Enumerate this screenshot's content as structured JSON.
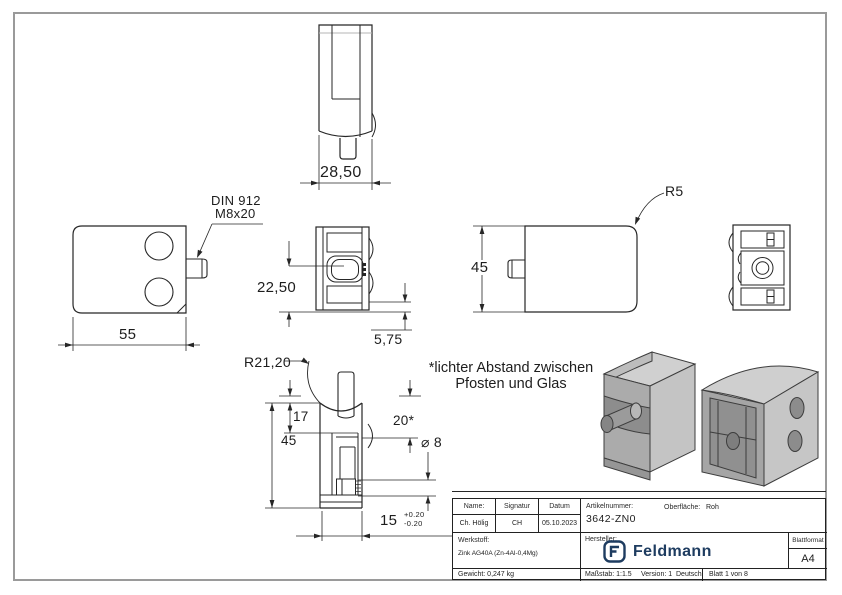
{
  "meta": {
    "line_color": "#262626",
    "frame_color": "#9a9a9a",
    "brand_color": "#1e3c60"
  },
  "views": {
    "top_view": {
      "dim_width": "28,50"
    },
    "front_left_view": {
      "screw_note_line1": "DIN 912",
      "screw_note_line2": "M8x20",
      "dim_width": "55"
    },
    "front_view": {
      "dim_center_height": "22,50",
      "dim_offset": "5,75"
    },
    "side_view": {
      "dim_radius": "R5",
      "dim_height": "45"
    },
    "back_view": {},
    "section_view": {
      "dim_radius": "R21,20",
      "dim_top": "17",
      "dim_height": "45",
      "dim_gap": "20*",
      "dim_hole": "⌀ 8",
      "dim_slot": "15",
      "tol_plus": "+0.20",
      "tol_minus": "-0.20"
    },
    "note": {
      "line1": "*lichter Abstand zwischen",
      "line2": "Pfosten und Glas"
    }
  },
  "title_block": {
    "name_label": "Name:",
    "name_value": "Ch. Hölig",
    "signature_label": "Signatur",
    "signature_value": "CH",
    "date_label": "Datum",
    "date_value": "05.10.2023",
    "article_label": "Artikelnummer:",
    "article_value": "3642-ZN0",
    "surface_label": "Oberfläche:",
    "surface_value": "Roh",
    "material_label": "Werkstoff:",
    "material_value": "Zink AG40A (Zn-4Al-0,4Mg)",
    "manufacturer_label": "Hersteller:",
    "brand_name": "Feldmann",
    "format_label": "Blattformat",
    "format_value": "A4",
    "weight_label": "Gewicht: 0,247 kg",
    "scale_label": "Maßstab: 1:1.5",
    "version_label": "Version: 1",
    "language_label": "Deutsch",
    "sheet_label": "Blatt 1 von 8"
  }
}
